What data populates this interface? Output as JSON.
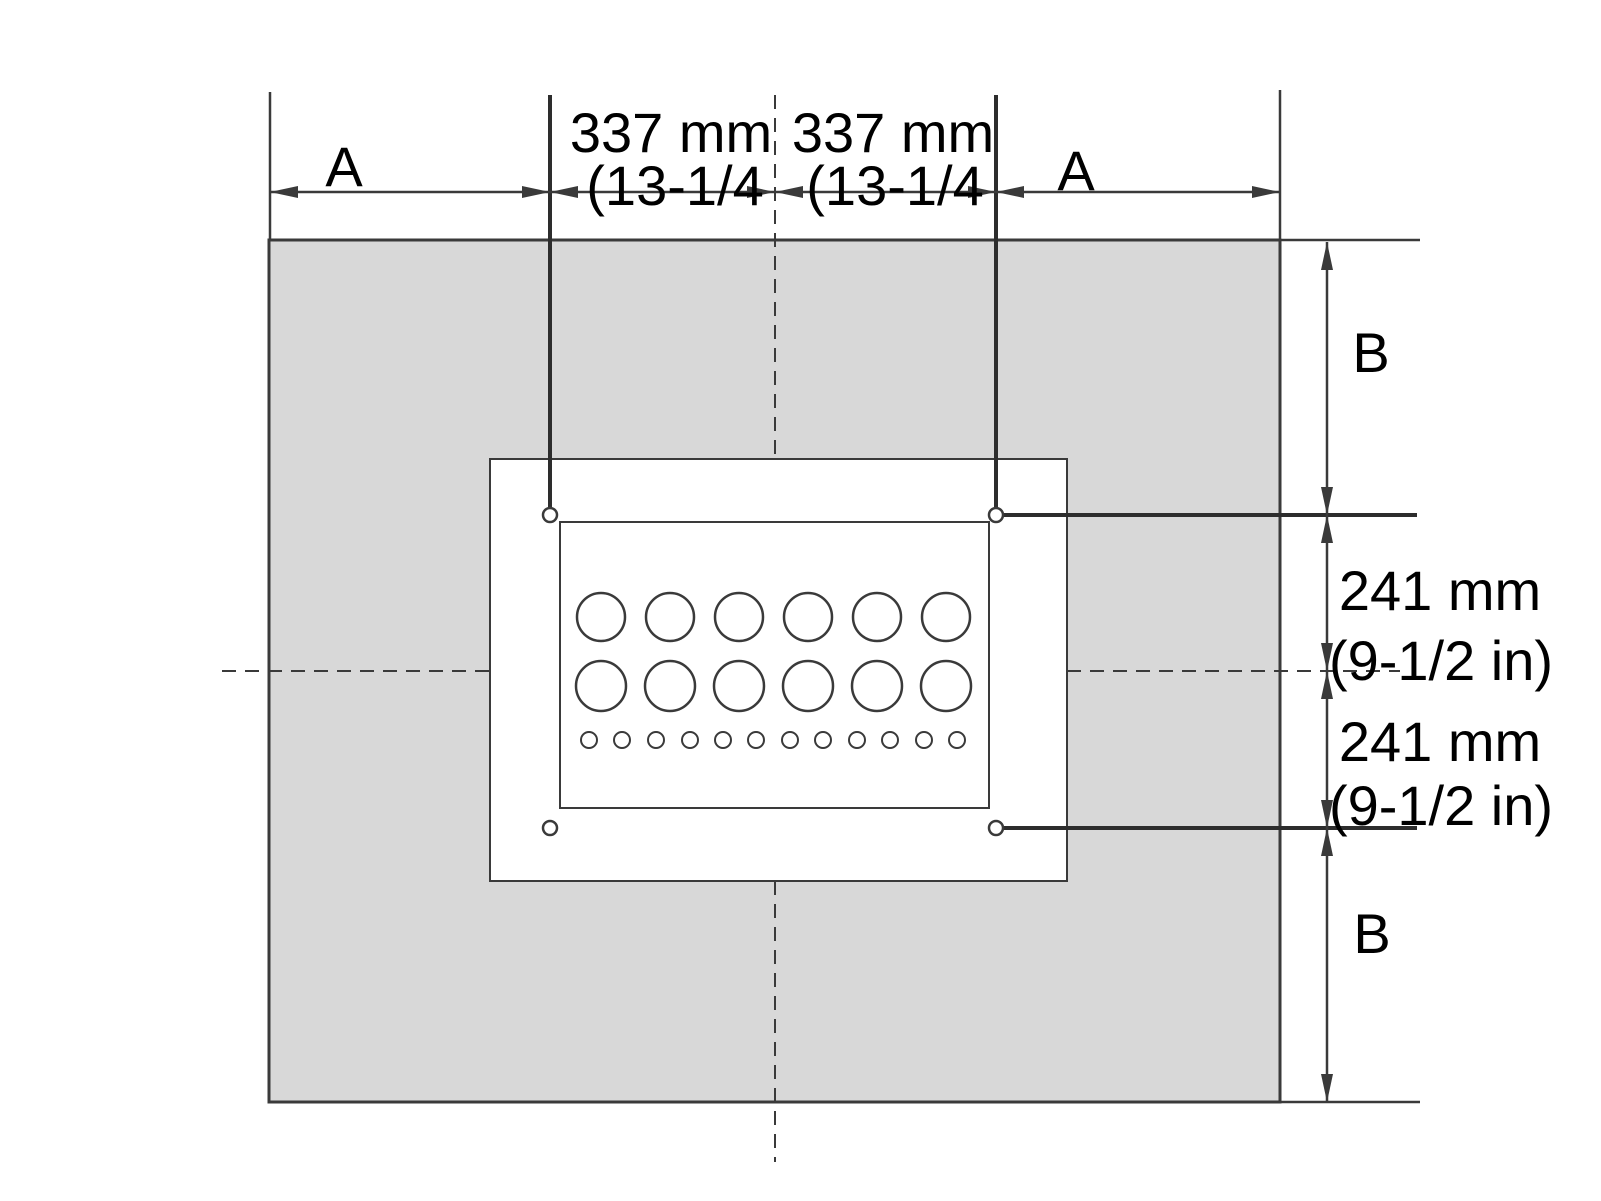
{
  "labels": {
    "dim_a_left": "A",
    "dim_a_right": "A",
    "dim_b_top": "B",
    "dim_b_bottom": "B",
    "dim_337_left": {
      "mm": "337 mm",
      "inch": "(13-1/4"
    },
    "dim_337_right": {
      "mm": "337 mm",
      "inch": "(13-1/4"
    },
    "dim_241_top": {
      "mm": "241 mm",
      "inch": "(9-1/2 in)"
    },
    "dim_241_bottom": {
      "mm": "241 mm",
      "inch": "(9-1/2 in)"
    }
  },
  "counts": {
    "mounting_holes": 4,
    "large_knockout_circles": 12,
    "small_knockout_circles": 12
  },
  "colors": {
    "wall_fill": "#d8d8d8",
    "line": "#3a3a3a",
    "text": "#000000",
    "background": "#ffffff"
  }
}
